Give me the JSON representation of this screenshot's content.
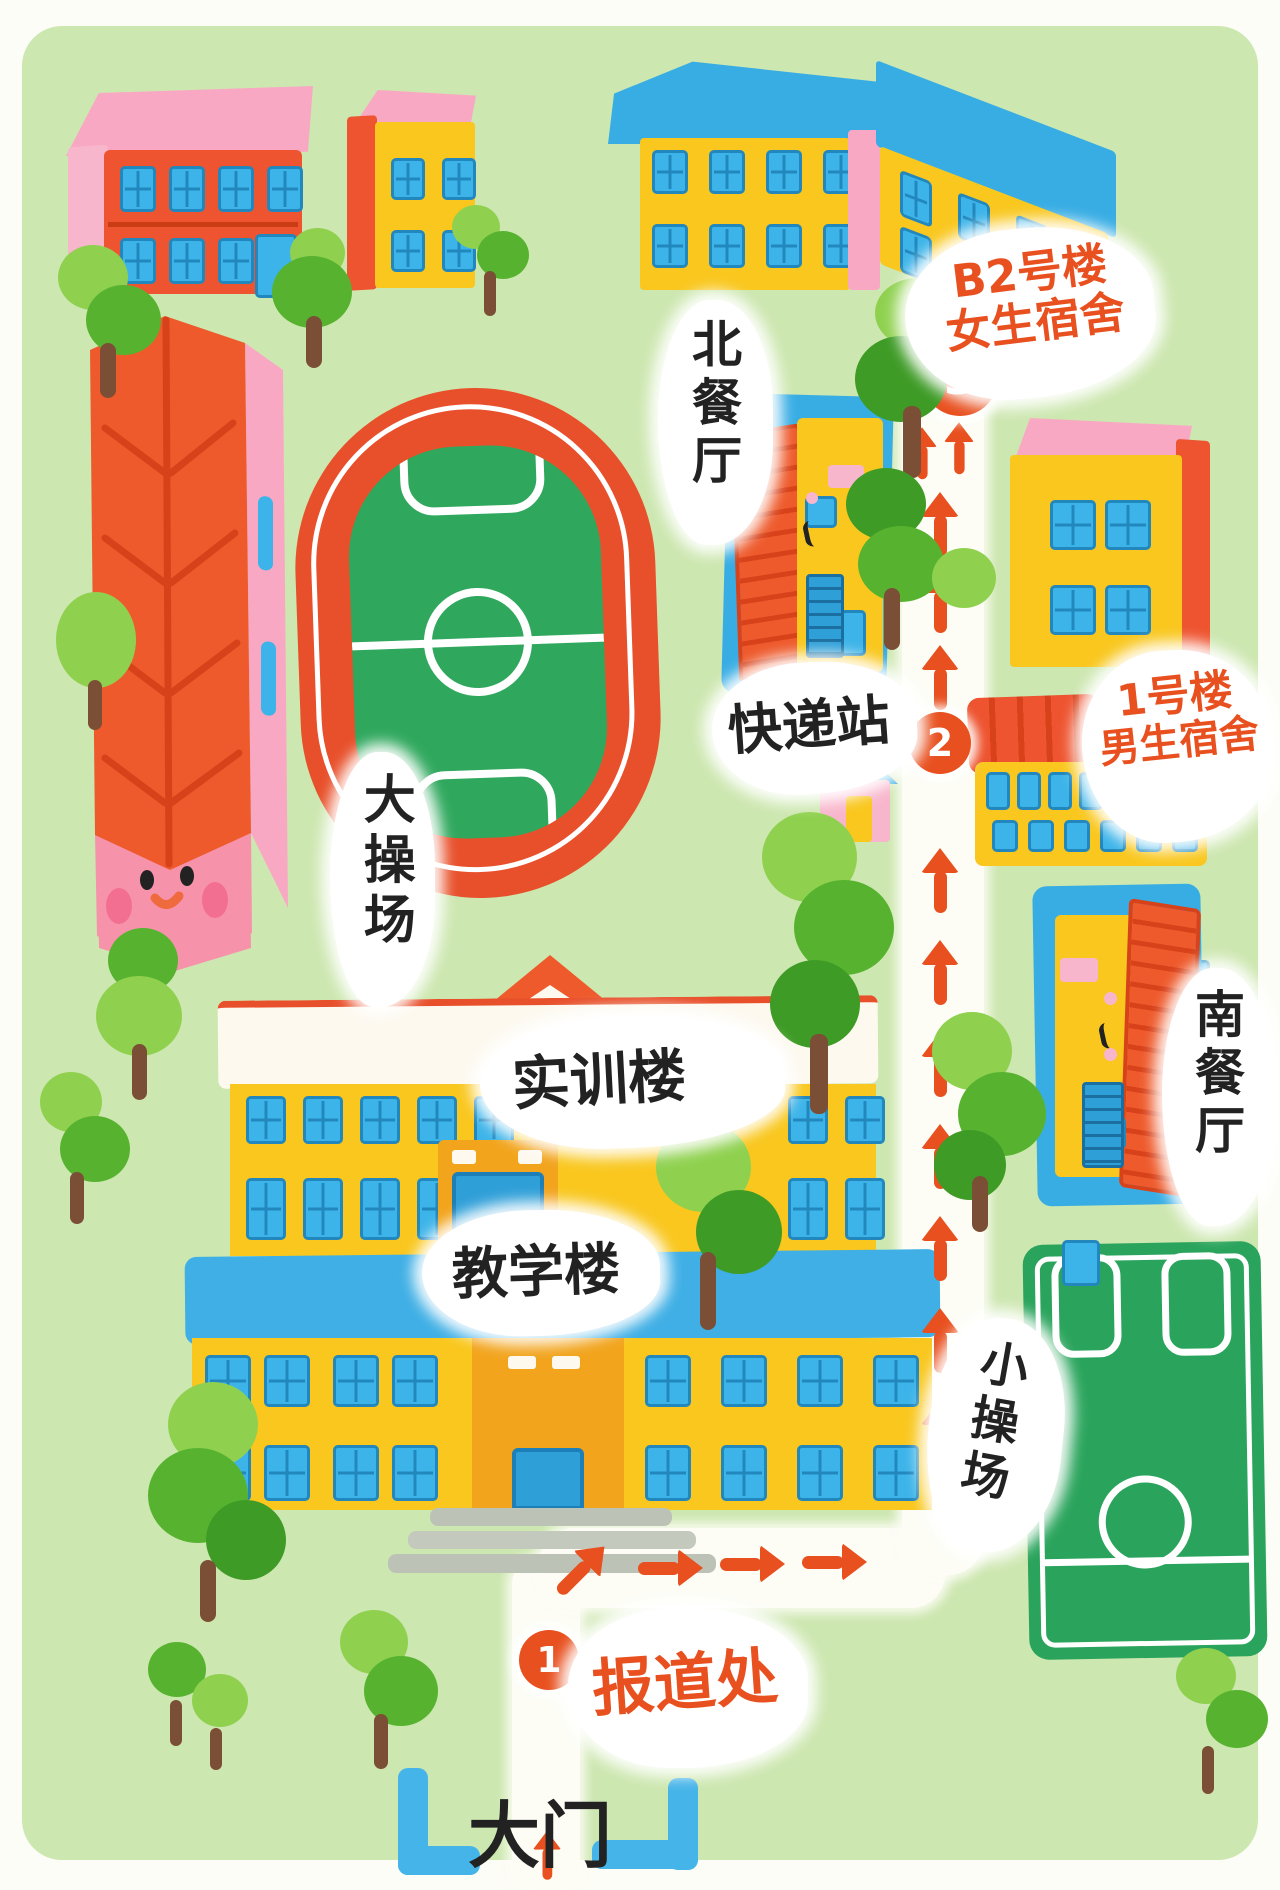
{
  "labels": {
    "gate": "大门",
    "registration": "报道处",
    "teaching_building": "教学楼",
    "training_building": "实训楼",
    "big_playground": "大操场",
    "small_playground": "小操场",
    "north_canteen": "北餐厅",
    "south_canteen": "南餐厅",
    "express_station": "快递站",
    "girls_dorm_line1": "B2号楼",
    "girls_dorm_line2": "女生宿舍",
    "boys_dorm_line1": "1号楼",
    "boys_dorm_line2": "男生宿舍"
  },
  "stops": [
    "1",
    "2",
    "3"
  ],
  "colors": {
    "grass_green": "#cde7b0",
    "accent_orange": "#e8501f",
    "building_orange": "#ee5430",
    "roof_pink": "#f9a8c3",
    "wall_yellow": "#f9c71e",
    "window_blue": "#3db4e9",
    "roof_blue": "#38ade4",
    "field_green": "#2fa85d",
    "tree_green": "#57b32f",
    "path_white": "#fdfdf6",
    "label_black": "#222222",
    "trunk_brown": "#7b4f36",
    "steps_gray": "#bdc2b7"
  }
}
